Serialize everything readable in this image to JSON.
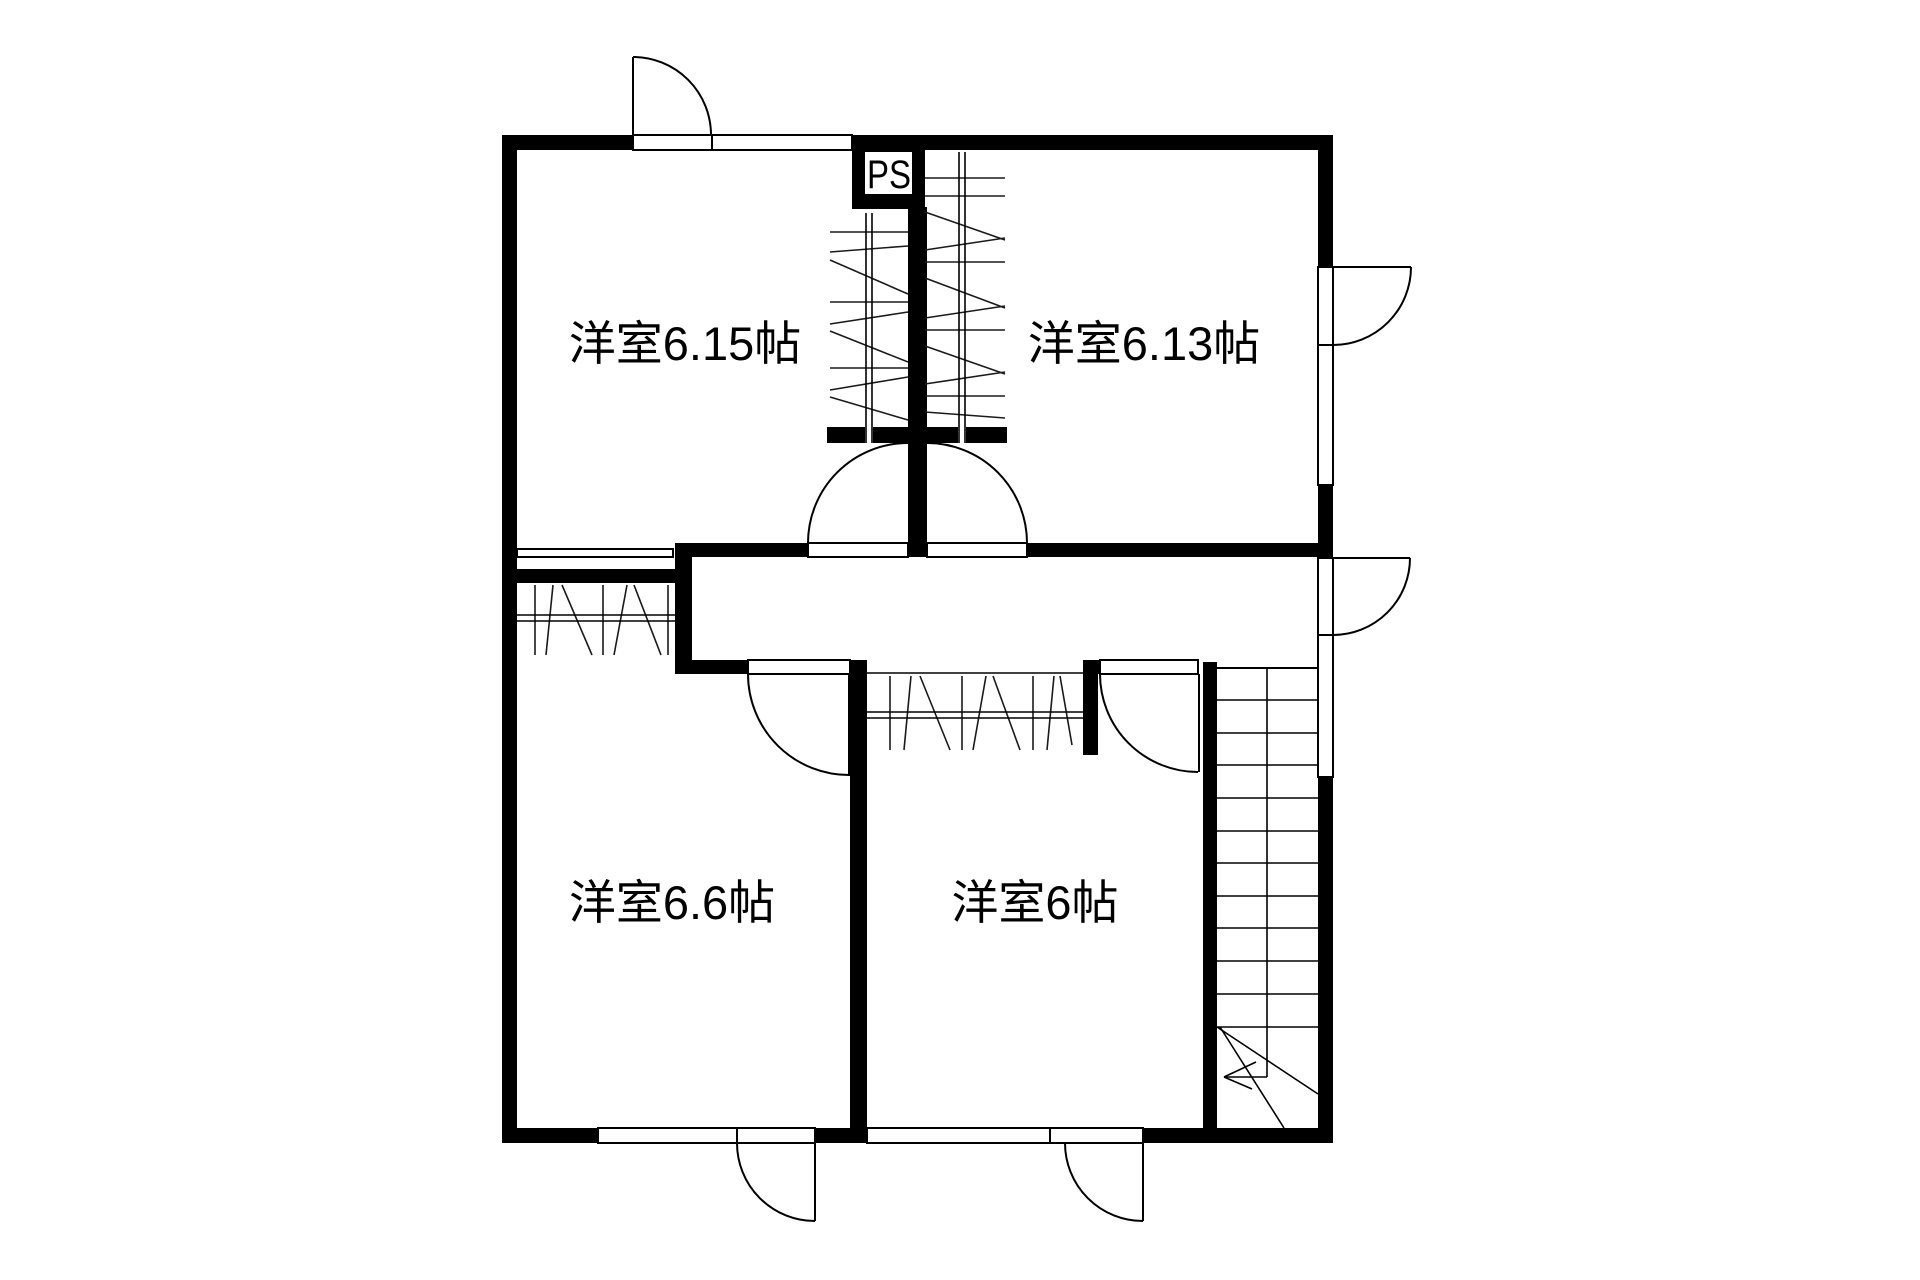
{
  "floorplan": {
    "background_color": "#ffffff",
    "wall_color": "#000000",
    "rooms": [
      {
        "id": "bedroom-1",
        "label": "洋室6.15帖",
        "size_tatami": "6.15"
      },
      {
        "id": "bedroom-2",
        "label": "洋室6.13帖",
        "size_tatami": "6.13"
      },
      {
        "id": "bedroom-3",
        "label": "洋室6.6帖",
        "size_tatami": "6.6"
      },
      {
        "id": "bedroom-4",
        "label": "洋室6帖",
        "size_tatami": "6"
      }
    ],
    "pipe_space": {
      "label": "PS"
    }
  }
}
